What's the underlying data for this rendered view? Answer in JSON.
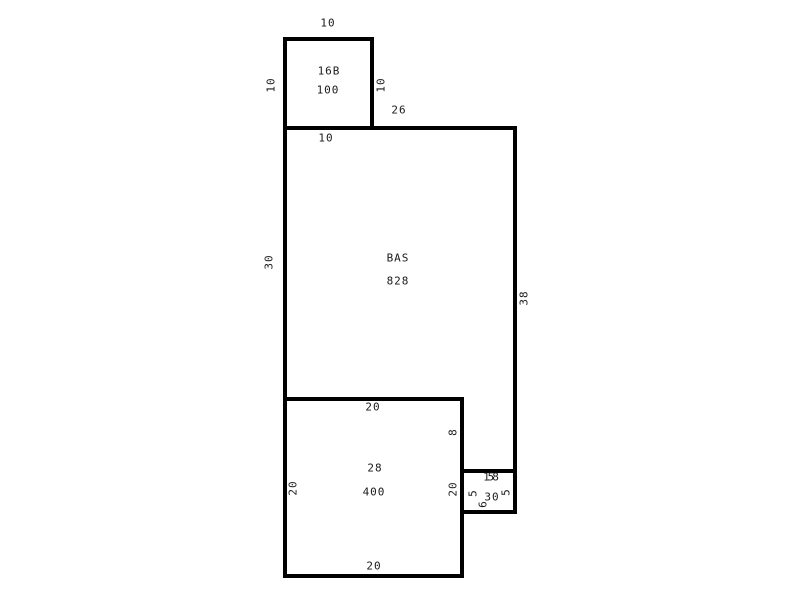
{
  "diagram": {
    "type": "property-floor-sketch",
    "background_color": "#ffffff",
    "line_color": "#000000",
    "areas": [
      {
        "name": "top-addition",
        "code": "16B",
        "area": "100",
        "dims": {
          "top": "10",
          "left": "10",
          "right": "10",
          "bottom": "10"
        }
      },
      {
        "name": "base-area",
        "code": "BAS",
        "area": "828",
        "dims": {
          "top": "26",
          "left": "30",
          "right": "38"
        }
      },
      {
        "name": "lower-addition",
        "code": "28",
        "area": "400",
        "dims": {
          "top": "20",
          "left": "20",
          "right": "20",
          "bottom": "20",
          "right_upper": "8"
        }
      },
      {
        "name": "small-porch",
        "code": "158",
        "area": "30",
        "dims": {
          "left": "5",
          "right": "5",
          "bottom": "6"
        }
      }
    ]
  }
}
